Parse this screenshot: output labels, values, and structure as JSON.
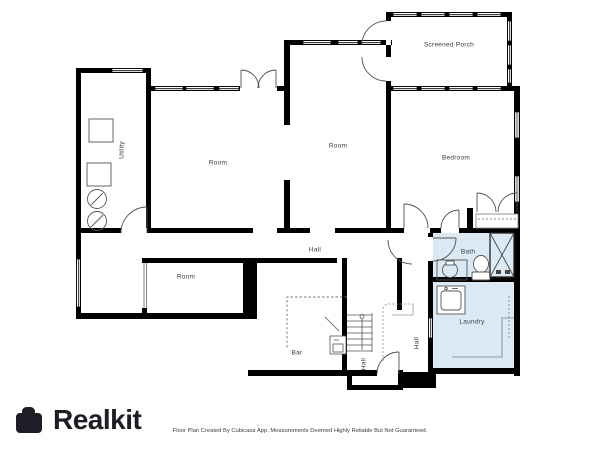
{
  "branding": {
    "logo_text": "Realkit",
    "logo_icon": "briefcase-icon"
  },
  "footer": {
    "disclaimer": "Floor Plan Created By Cubicasa App. Measurements Deemed Highly Reliable But Not Guaranteed."
  },
  "floor_plan": {
    "highlight_color": "#dbe9f5",
    "wall_color": "#000000",
    "rooms": {
      "utility": "Utility",
      "room_left": "Room",
      "room_center": "Room",
      "screened_porch": "Screened Porch",
      "bedroom": "Bedroom",
      "hall_main": "Hall",
      "room_lower": "Room",
      "bar": "Bar",
      "hall_stairs": "Hall",
      "hall_side": "Hall",
      "bath": "Bath",
      "laundry": "Laundry"
    }
  }
}
